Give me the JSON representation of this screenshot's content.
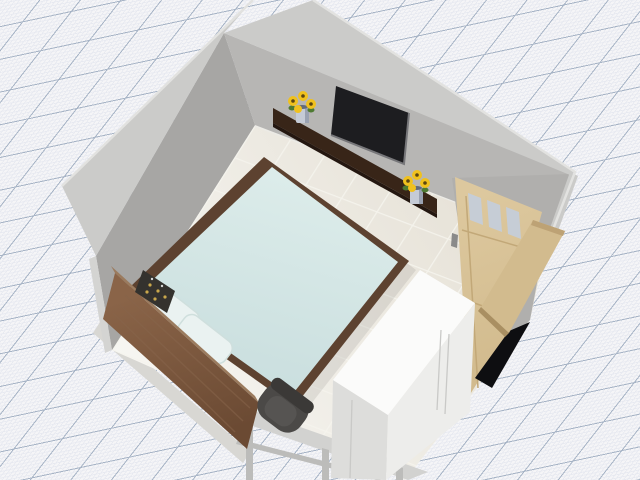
{
  "scene": {
    "type": "3d-room-plan-render",
    "room": "bedroom",
    "objects": [
      "left wall",
      "back wall",
      "right wall",
      "tiled floor",
      "double bed with light-blue duvet",
      "two pillows",
      "walnut headboard",
      "dark wall shelf",
      "flat-screen tv",
      "sunflower vase left",
      "sunflower vase right",
      "open wooden door with three glass panes",
      "doorway",
      "white wardrobe cabinet",
      "desk",
      "dark desk chair",
      "wall panel decor"
    ]
  },
  "colors": {
    "grid_bg": "#f5f5f7",
    "grid_minor": "#e7e9f0",
    "grid_major": "#a7b4c6",
    "wall_exterior": "#cbcbc9",
    "wall_top_edge": "#e2e2e0",
    "wall_left": "#a7a6a4",
    "wall_back": "#b7b6b4",
    "wall_door": "#b0afad",
    "wall_cut": "#d4d4d2",
    "baseboard": "#ecebe6",
    "slab_edge": "#d8d7d3",
    "floor_back": "#e5e0d5",
    "floor_front": "#f7f6f2",
    "floor_grout": "#f6f4ee",
    "bed_frame": "#5d4230",
    "duvet_light": "#dcecea",
    "duvet": "#c9dede",
    "duvet_fold": "#e3eeec",
    "pillow": "#eaf2f1",
    "pillow_edge": "#cfdfdd",
    "headboard_light": "#8a6448",
    "headboard": "#6b4a33",
    "headboard_edge": "#9b7b5e",
    "headboard_grain": "#87644a",
    "shelf": "#382518",
    "shelf_edge": "#241710",
    "tv": "#1d1d20",
    "tv_edge": "#77777a",
    "flower_petal": "#f0c11e",
    "flower_center": "#5a4512",
    "leaf_green": "#4e7a32",
    "vase": "#c5cbd6",
    "vase_shade": "#9aa2b2",
    "vase_mouth": "#636b7a",
    "door_wood_light": "#ddc89e",
    "door_wood": "#d2bb8e",
    "door_wood_dark": "#bda275",
    "door_edge": "#a98f62",
    "door_line": "#c2a878",
    "window_glass": "#c6cdd6",
    "handle": "#8a8a8a",
    "door_gap": "#0e0e11",
    "dresser_top": "#fbfbfa",
    "dresser_side": "#dddddb",
    "dresser_front": "#ededeb",
    "dresser_line": "#c9c9c7",
    "desk": "#d2d2d0",
    "desk_leg": "#bcbcba",
    "chair": "#4b4947",
    "chair_rim": "#3b3937",
    "chair_inner": "#565452",
    "panel": "#34322e",
    "panel_gold": "#c9a84c",
    "panel_white": "#d6d6d6",
    "shadow": "rgba(0,0,0,0.08)"
  }
}
